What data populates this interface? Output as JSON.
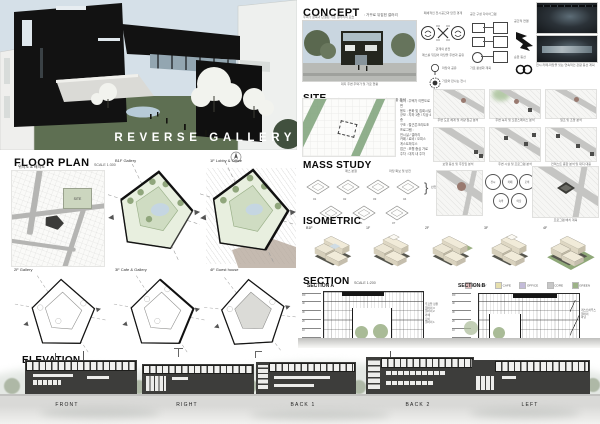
{
  "poster": {
    "title": "REVERSE GALLERY"
  },
  "concept": {
    "title": "CONCEPT",
    "subtitle": ": 거꾸로 뒤집힌 갤러리",
    "intro": "주택가 골목과 단절된 기존 갤러리의 모습",
    "photo_caption": "대지 주변 주택가 및 가로 현황",
    "process": {
      "caption_top": "폐쇄적인 전시공간과 닫힌 경계",
      "caption_mid": "관계의 반전",
      "caption_bottom": "매스를 뒤집어 마당을 주변과 공유",
      "tree_note": "마당의 공유",
      "stamp_note": "가로와 만나는 전시"
    },
    "diagram": {
      "caption": "공간 구성 다이어그램",
      "caption2": "가로 활성화 계획",
      "arrow_caption": "공간적 연결",
      "chain_caption": "순환 동선",
      "chain_note": "전시-카페-마당을 잇는 연속적인 관람 동선 계획"
    }
  },
  "site": {
    "title": "SITE",
    "subtitle": ": 주거밀집지역 내 경사 대지와 주변 가로 현황 분석",
    "info_lines": [
      "위치 : 주택가 이면도로 변",
      "용도 : 문화 및 집회시설",
      "규모 : 지하 1층 / 지상 4층",
      "구조 : 철근콘크리트조",
      "프로그램 :",
      "전시실 / 갤러리",
      "카페 / 로비 / 오피스",
      "게스트하우스",
      "접근 : 보행 중심 가로",
      "주차 : 대지 내 주차"
    ],
    "mini_maps": [
      "주변 도로 체계 및 차량 접근 분석",
      "주변 녹지 및 오픈스페이스 분석",
      "일조 및 조망 분석",
      "보행 동선 및 주진입 분석",
      "주변 시설 및 프로그램 분석",
      "컨텍스트 종합 분석 및 대지 대응"
    ]
  },
  "floor_plan": {
    "title": "FLOOR PLAN",
    "scale": "SCALE 1:300",
    "site_label": "위치도 & 배치도",
    "site_tag": "SITE",
    "plans": [
      "B1F Gallery",
      "1F Lobby & Office",
      "2F Gallery",
      "3F Cafe & Gallery",
      "4F Guest house"
    ]
  },
  "mass_study": {
    "title": "MASS STUDY",
    "annotations": [
      "매스 분절",
      "마당 확보 및 반전"
    ],
    "steps": [
      "01",
      "02",
      "03",
      "04",
      "05",
      "06",
      "07"
    ],
    "bracket_note": "반전"
  },
  "program": {
    "circles": [
      "전시",
      "카페",
      "로비",
      "숙박",
      "마당"
    ],
    "map_caption": "프로그램 배치 계획"
  },
  "isometric": {
    "title": "ISOMETRIC",
    "labels": [
      "B1F",
      "1F",
      "2F",
      "3F",
      "4F"
    ]
  },
  "section": {
    "title": "SECTION",
    "scale": "SCALE 1:200",
    "a_title": "SECTION A",
    "b_title": "SECTION B",
    "legend": [
      {
        "label": "GALLERY",
        "color": "#e0bcbc"
      },
      {
        "label": "CAFE",
        "color": "#e6dfad"
      },
      {
        "label": "OFFICE",
        "color": "#c3bbd9"
      },
      {
        "label": "CORE",
        "color": "#c7c7c7"
      },
      {
        "label": "GREEN",
        "color": "#9cb287"
      }
    ],
    "levels": [
      "RF",
      "4F",
      "3F",
      "2F",
      "1F",
      "GL"
    ],
    "a_notes": [
      "루프탑 정원",
      "갤러리 3",
      "갤러리 2",
      "카페",
      "로비",
      "갤러리 1"
    ],
    "b_notes": [
      "게스트하우스",
      "갤러리",
      "마당"
    ]
  },
  "elevation": {
    "title": "ELEVATION",
    "scale": "SCALE 1:200",
    "labels": [
      "FRONT",
      "RIGHT",
      "BACK 1",
      "BACK 2",
      "LEFT"
    ]
  }
}
